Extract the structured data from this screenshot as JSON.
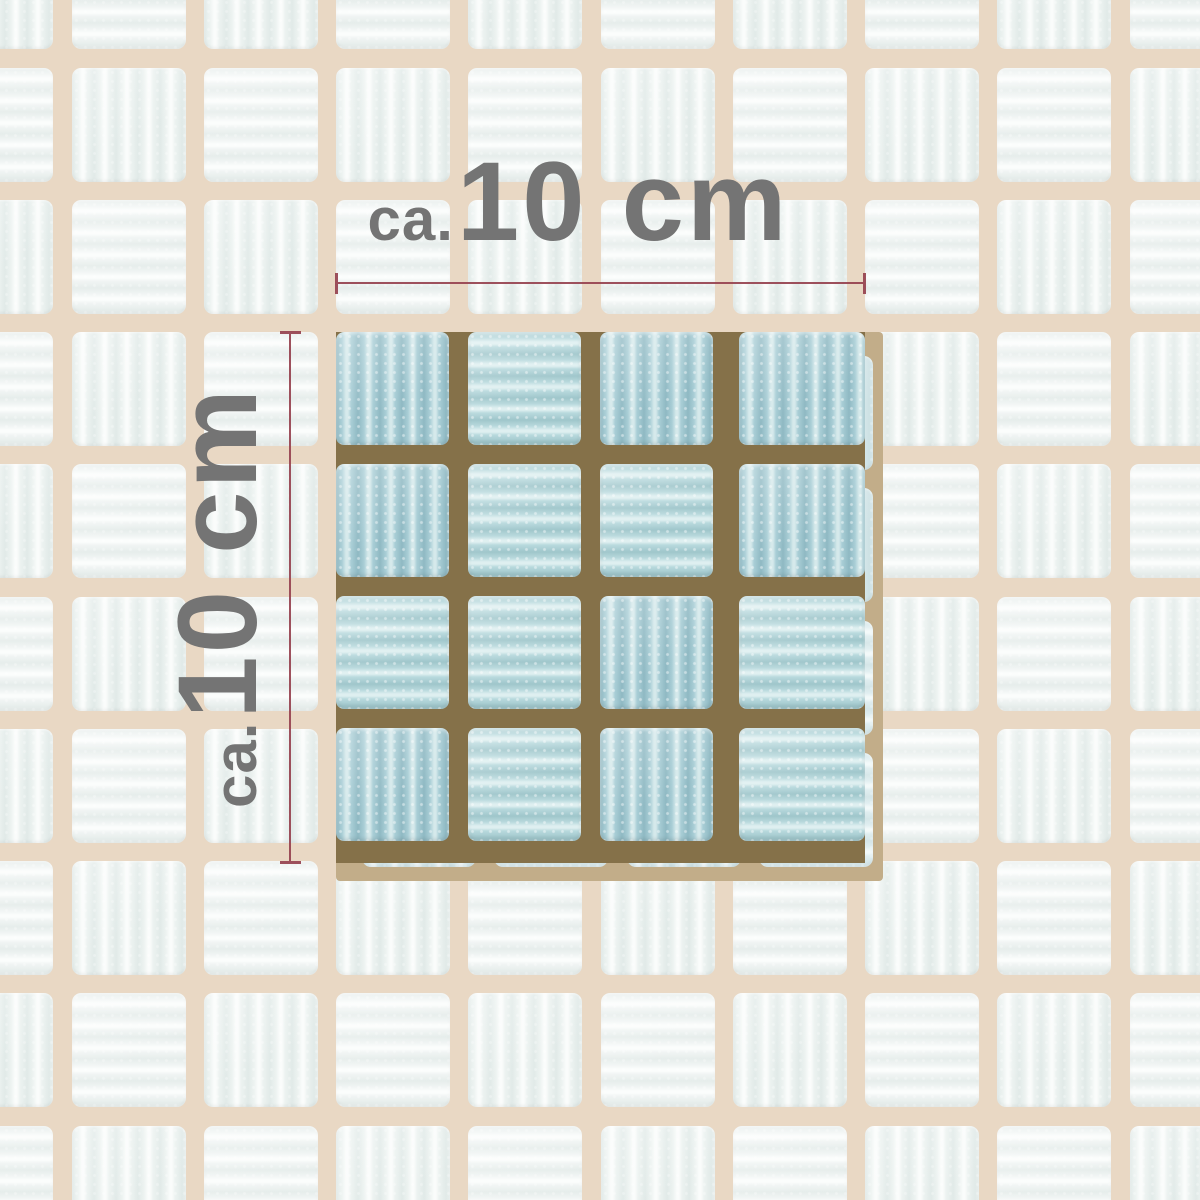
{
  "image_subject": "White and light blue ceramic mosaic tile sheet with size annotation",
  "annotation": {
    "width_label": {
      "prefix": "ca.",
      "value": "10 cm"
    },
    "height_label": {
      "prefix": "ca.",
      "value": "10 cm"
    },
    "label_color": "#747474",
    "line_color": "#96424f"
  },
  "mosaic": {
    "outer": {
      "grout_color": "#e9d8c4",
      "tile_v": {
        "base": "#edf3f1",
        "dark": "#e1eae8",
        "light": "#fafcfb"
      },
      "tile_h": {
        "base": "#f1f5f4",
        "dark": "#e6edeb",
        "light": "#fbfdfc"
      }
    },
    "highlight": {
      "grout_color": "#857149",
      "tile_v": {
        "base": "#a9ced6",
        "dark": "#8fb9c3",
        "light": "#d5e9eb"
      },
      "tile_h": {
        "base": "#b8d9dd",
        "dark": "#9fc6cb",
        "light": "#deeff0"
      },
      "ridge_pattern": [
        [
          "v",
          "h",
          "v",
          "v"
        ],
        [
          "v",
          "h",
          "h",
          "v"
        ],
        [
          "h",
          "h",
          "v",
          "h"
        ],
        [
          "v",
          "h",
          "v",
          "h"
        ]
      ]
    },
    "washed_block": {
      "grout_color": "#c2ad89",
      "tile_v": {
        "base": "#d9eaec",
        "dark": "#cde1e4",
        "light": "#eef6f7"
      },
      "tile_h": {
        "base": "#e0eef0",
        "dark": "#d5e6e8",
        "light": "#f2f9f9"
      }
    }
  }
}
